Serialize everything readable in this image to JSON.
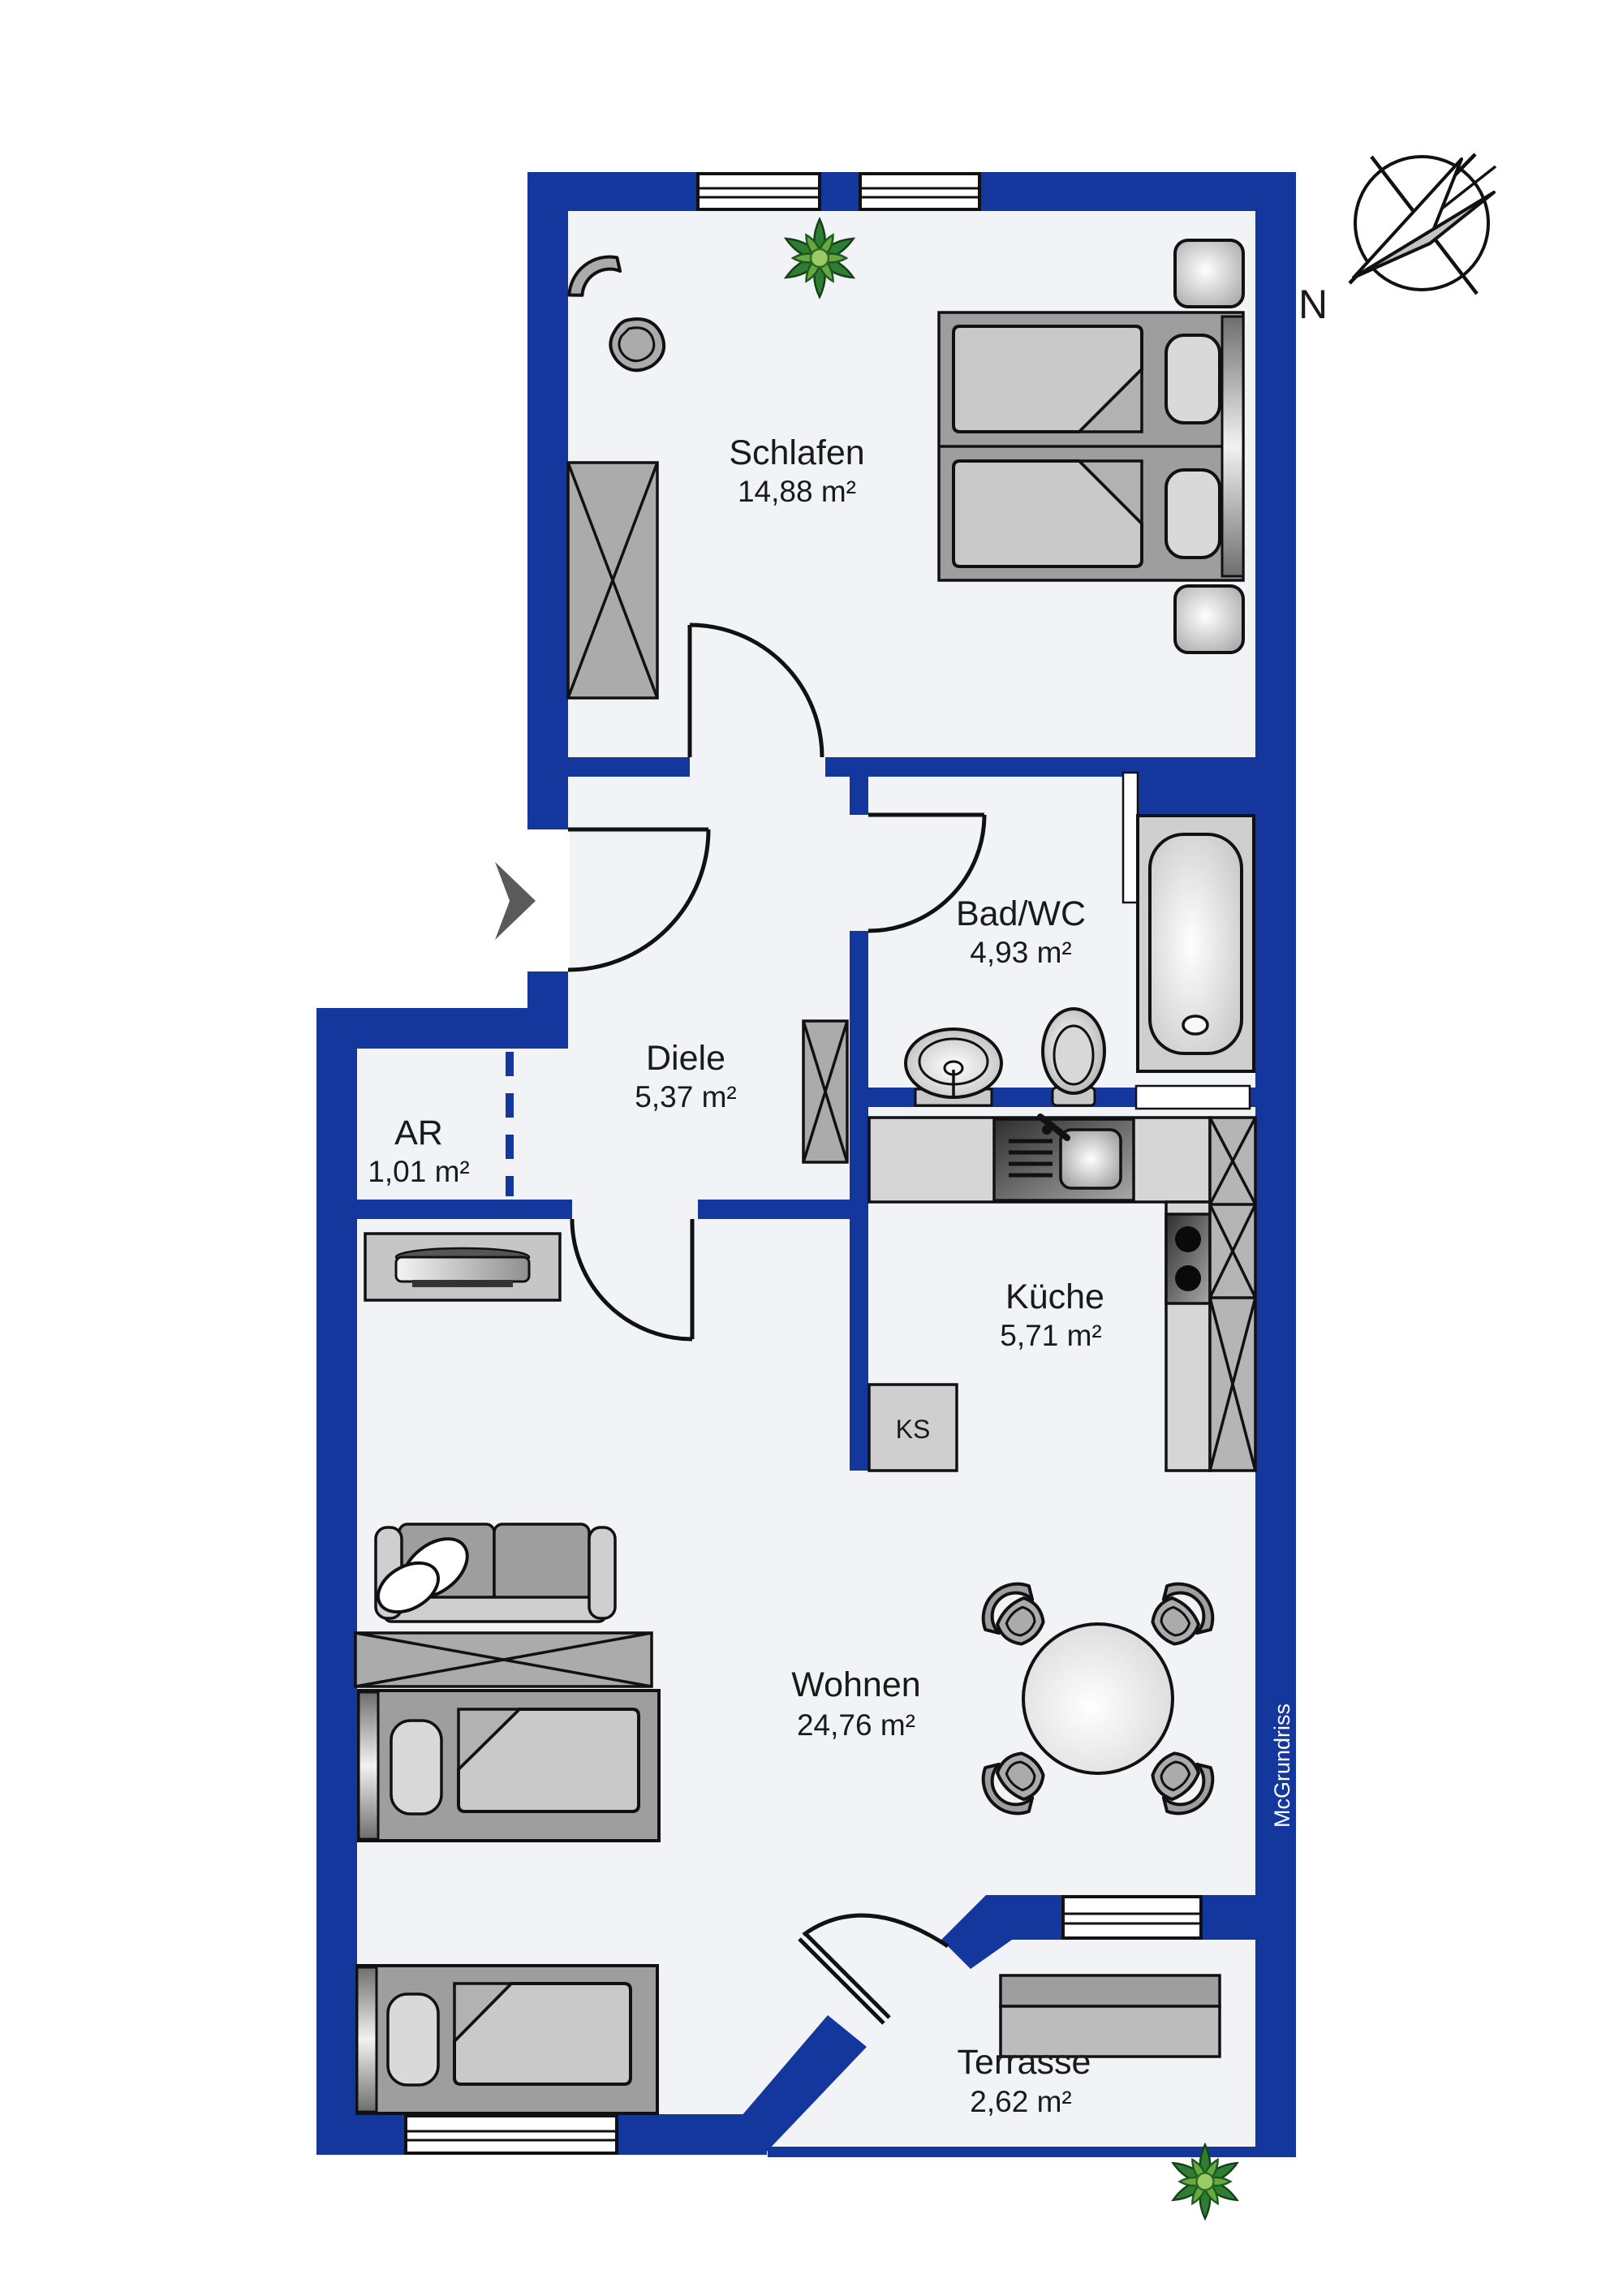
{
  "rooms": {
    "schlafen": {
      "name": "Schlafen",
      "area": "14,88 m²"
    },
    "bad": {
      "name": "Bad/WC",
      "area": "4,93 m²"
    },
    "diele": {
      "name": "Diele",
      "area": "5,37 m²"
    },
    "ar": {
      "name": "AR",
      "area": "1,01 m²"
    },
    "kueche": {
      "name": "Küche",
      "area": "5,71 m²"
    },
    "wohnen": {
      "name": "Wohnen",
      "area": "24,76 m²"
    },
    "terrasse": {
      "name": "Terrasse",
      "area": "2,62 m²"
    }
  },
  "labels": {
    "fridge": "KS",
    "compass_north": "N",
    "watermark": "McGrundriss"
  },
  "colors": {
    "wall": "#14379E",
    "floor": "#F2F3F7",
    "outline": "#111111",
    "text": "#1a1a1a",
    "furniture": "#ABABAB",
    "furniture_dark": "#9E9E9E",
    "furniture_light": "#D2D2D2",
    "plant_green": "#4F9A35",
    "arrow": "#5A5A5A",
    "watermark": "#FFFFFF"
  }
}
